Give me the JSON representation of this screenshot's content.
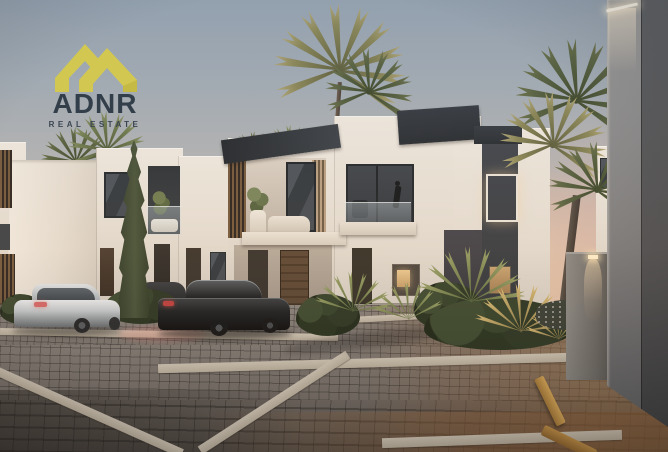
{
  "brand": {
    "name": "ADNR",
    "tagline": "REAL ESTATE",
    "icon": "roof-chevrons-icon",
    "colors": {
      "icon": "#d2c851",
      "text": "#333e4b"
    }
  },
  "scene": {
    "time_of_day": "dusk",
    "subject": "modern white townhouse community with palm trees, cypress, parked cars and cobblestone driveway",
    "palette": {
      "sky_top": "#97a4b1",
      "sky_horizon": "#e7cab2",
      "building_white": "#efe9df",
      "building_charcoal": "#2e343a",
      "wood_door": "#5c4734",
      "pavement_gray": "#7b756f",
      "pavement_warm": "#8a6e52",
      "concrete_strip": "#cac0b0",
      "foliage_dark": "#3a462e",
      "foliage_olive": "#6e7b4e",
      "window_glow": "#f2d49c",
      "curb_yellow": "#cf9c4c"
    },
    "objects": [
      "townhouse-row",
      "cypress-tree",
      "palm-trees",
      "white-sedan",
      "black-sedan",
      "cobblestone-driveway",
      "parking-curbs",
      "wall-lamp",
      "foreground-building",
      "flower-bed"
    ]
  }
}
